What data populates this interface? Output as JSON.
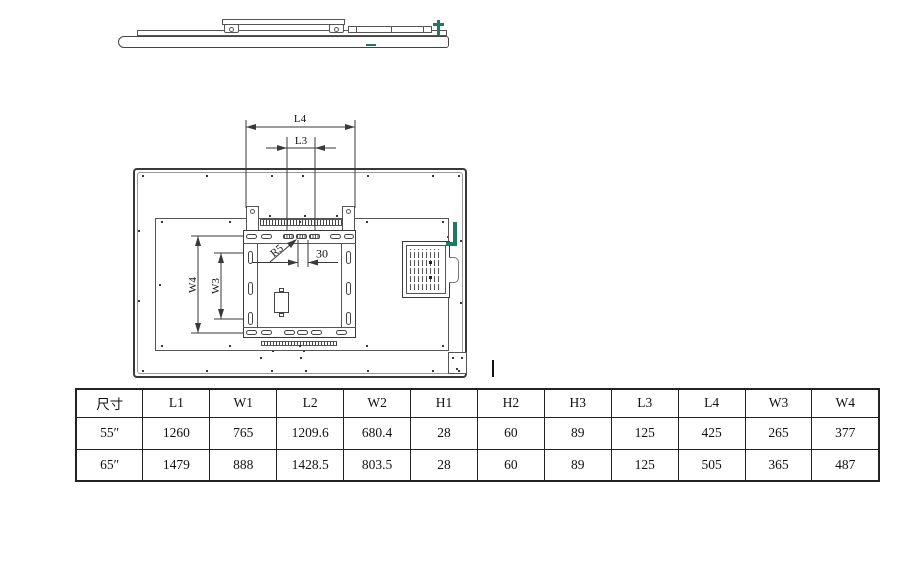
{
  "drawing": {
    "dim_l4": "L4",
    "dim_l3": "L3",
    "dim_w4": "W4",
    "dim_w3": "W3",
    "radius_label": "R5",
    "hole_spacing_label": "30"
  },
  "table": {
    "columns": [
      "尺寸",
      "L1",
      "W1",
      "L2",
      "W2",
      "H1",
      "H2",
      "H3",
      "L3",
      "L4",
      "W3",
      "W4"
    ],
    "rows": [
      [
        "55″",
        "1260",
        "765",
        "1209.6",
        "680.4",
        "28",
        "60",
        "89",
        "125",
        "425",
        "265",
        "377"
      ],
      [
        "65″",
        "1479",
        "888",
        "1428.5",
        "803.5",
        "28",
        "60",
        "89",
        "125",
        "505",
        "365",
        "487"
      ]
    ]
  },
  "colors": {
    "line": "#3a3a3a",
    "accent-green": "#1b7a64"
  }
}
